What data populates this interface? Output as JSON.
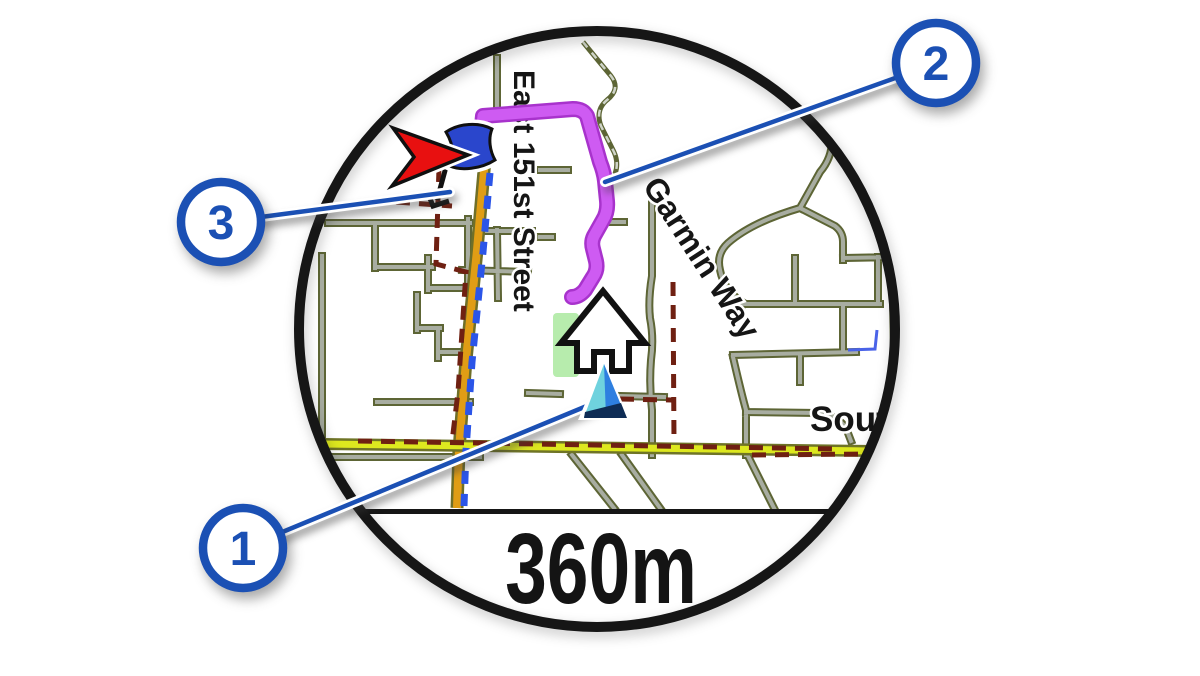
{
  "figure": {
    "type": "watch-map-navigation-illustration",
    "scale_label": "360m"
  },
  "map": {
    "street_labels": {
      "east_151st": "East 151st Street",
      "garmin_way": "Garmin Way",
      "south_partial": "Sout"
    },
    "icons": [
      "destination-flag-icon",
      "direction-arrow-icon",
      "heading-arrow-icon",
      "position-marker-icon"
    ],
    "colors": {
      "route": "#ce5bf2",
      "major_road_orange": "#e09d15",
      "highway_yellow": "#dde81f",
      "street_core": "#a8ada1",
      "street_casing": "#5d6535",
      "boundary_maroon": "#6f2012",
      "navigation_dash_blue": "#2b55e8",
      "park_green": "#b7ecad",
      "water_blue": "#4a63e8",
      "position_marker_blue": "#2e7fe0",
      "position_marker_cyan": "#6fd2de",
      "destination_flag_blue": "#2a46cc",
      "direction_arrow_red": "#e81010",
      "callout_blue": "#1b50b4",
      "bezel_black": "#161616"
    }
  },
  "callouts": [
    {
      "number": "1",
      "target": "position-marker"
    },
    {
      "number": "2",
      "target": "route-line"
    },
    {
      "number": "3",
      "target": "destination-flag"
    }
  ]
}
